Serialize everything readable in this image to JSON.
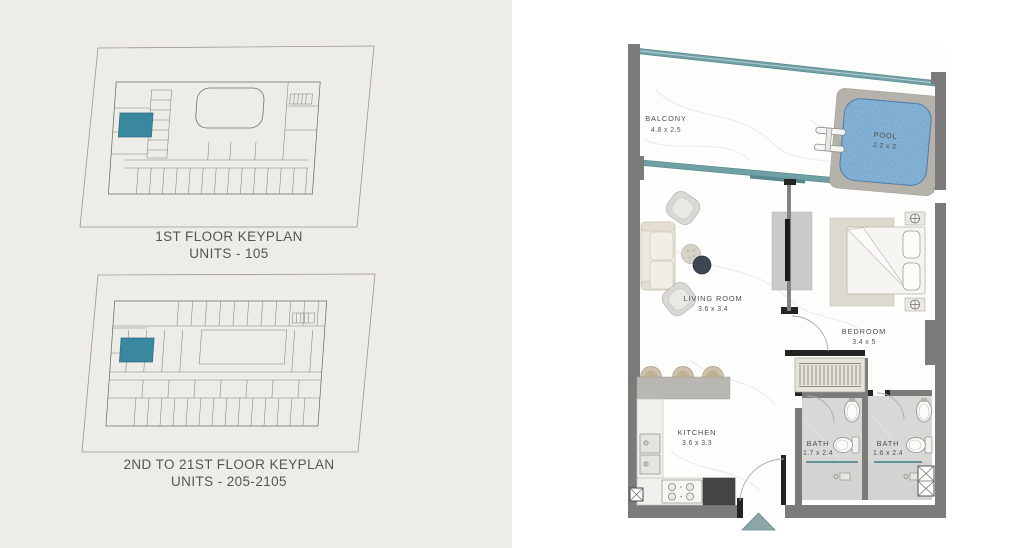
{
  "keyplans": [
    {
      "title": "1ST FLOOR KEYPLAN",
      "subtitle": "UNITS - 105",
      "highlight_color": "#3a87a0"
    },
    {
      "title": "2ND TO 21ST FLOOR KEYPLAN",
      "subtitle": "UNITS - 205-2105",
      "highlight_color": "#3a87a0"
    }
  ],
  "unit_plan": {
    "labels": {
      "balcony": {
        "name": "BALCONY",
        "dims": "4.8 x 2.5"
      },
      "pool": {
        "name": "POOL",
        "dims": "2.2 x 2"
      },
      "living_room": {
        "name": "LIVING ROOM",
        "dims": "3.6 x 3.4"
      },
      "bedroom": {
        "name": "BEDROOM",
        "dims": "3.4 x 5"
      },
      "kitchen": {
        "name": "KITCHEN",
        "dims": "3.6 x 3.3"
      },
      "bath_1": {
        "name": "BATH",
        "dims": "1.7 x 2.4"
      },
      "bath_2": {
        "name": "BATH",
        "dims": "1.6 x 2.4"
      }
    },
    "colors": {
      "wall": "#7c7b79",
      "glass": "#6fa0a6",
      "pool_water": "#83b1d4",
      "entry_marker": "#8ba6a9"
    }
  }
}
